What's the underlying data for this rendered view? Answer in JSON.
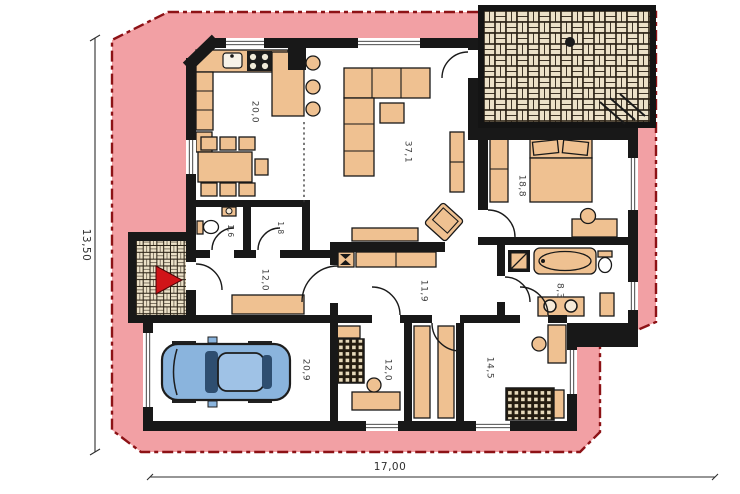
{
  "plan": {
    "type": "single-storey-house-floor-plan",
    "rooms": [
      {
        "name": "kitchen-dining",
        "area": "20,0"
      },
      {
        "name": "living-room",
        "area": "37,1"
      },
      {
        "name": "bedroom-1",
        "area": "18,8"
      },
      {
        "name": "wc",
        "area": "1,6"
      },
      {
        "name": "pantry",
        "area": "1,8"
      },
      {
        "name": "hall",
        "area": "12,0"
      },
      {
        "name": "corridor",
        "area": "11,9"
      },
      {
        "name": "bathroom",
        "area": "8,3"
      },
      {
        "name": "garage",
        "area": "20,9"
      },
      {
        "name": "bedroom-2",
        "area": "12,0"
      },
      {
        "name": "bedroom-3",
        "area": "14,5"
      }
    ],
    "dimensions": {
      "horizontal": "17,00",
      "vertical": "13,50"
    },
    "colors": {
      "band": "#f2a0a4",
      "band_border": "#8d1216",
      "wall": "#181818",
      "furniture": "#efc191",
      "car_body": "#8ab4dd",
      "car_roof": "#9fc2e6",
      "glass": "#2e4e70",
      "arrow": "#d01418",
      "brick_bg": "#2a2115",
      "brick": "#ece1c8"
    },
    "icons": {
      "entrance_arrow": "entrance-arrow"
    }
  }
}
